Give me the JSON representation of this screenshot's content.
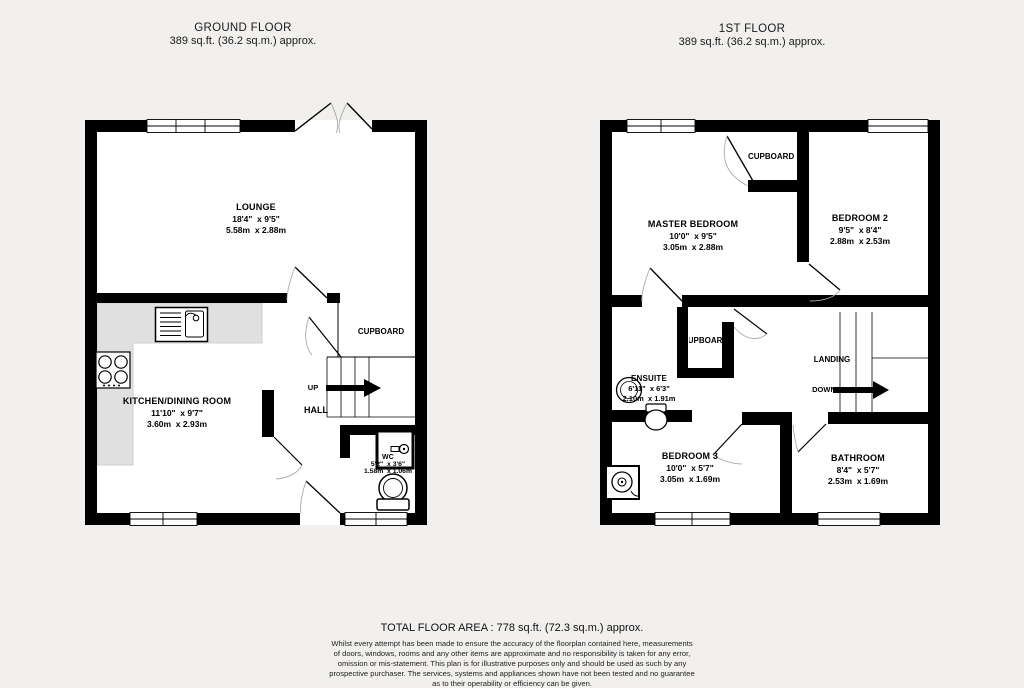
{
  "ground_floor": {
    "title": "GROUND FLOOR",
    "subtitle": "389 sq.ft. (36.2 sq.m.) approx.",
    "rooms": {
      "lounge": {
        "name": "LOUNGE",
        "imperial": "18'4\"  x 9'5\"",
        "metric": "5.58m  x 2.88m"
      },
      "kitchen": {
        "name": "KITCHEN/DINING ROOM",
        "imperial": "11'10\"  x 9'7\"",
        "metric": "3.60m  x 2.93m"
      },
      "wc": {
        "name": "WC",
        "imperial": "5'2\"  x 3'6\"",
        "metric": "1.58m  x 1.06m"
      },
      "cupboard": {
        "name": "CUPBOARD"
      },
      "hall": {
        "name": "HALL"
      }
    },
    "stairs_label": "UP"
  },
  "first_floor": {
    "title": "1ST FLOOR",
    "subtitle": "389 sq.ft. (36.2 sq.m.) approx.",
    "rooms": {
      "master_bedroom": {
        "name": "MASTER BEDROOM",
        "imperial": "10'0\"  x 9'5\"",
        "metric": "3.05m  x 2.88m"
      },
      "bedroom2": {
        "name": "BEDROOM 2",
        "imperial": "9'5\"  x 8'4\"",
        "metric": "2.88m  x 2.53m"
      },
      "ensuite": {
        "name": "ENSUITE",
        "imperial": "6'11\"  x 6'3\"",
        "metric": "2.10m  x 1.91m"
      },
      "bedroom3": {
        "name": "BEDROOM 3",
        "imperial": "10'0\"  x 5'7\"",
        "metric": "3.05m  x 1.69m"
      },
      "bathroom": {
        "name": "BATHROOM",
        "imperial": "8'4\"  x 5'7\"",
        "metric": "2.53m  x 1.69m"
      },
      "cupboard_top": {
        "name": "CUPBOARD"
      },
      "cupboard_mid": {
        "name": "CUPBOARD"
      },
      "landing": {
        "name": "LANDING"
      }
    },
    "stairs_label": "DOWN"
  },
  "footer": {
    "total": "TOTAL FLOOR AREA : 778 sq.ft. (72.3 sq.m.) approx.",
    "disclaimer_lines": [
      "Whilst every attempt has been made to ensure the accuracy of the floorplan contained here, measurements",
      "of doors, windows, rooms and any other items are approximate and no responsibility is taken for any error,",
      "omission or mis-statement. This plan is for illustrative purposes only and should be used as such by any",
      "prospective purchaser. The services, systems and appliances shown have not been tested and no guarantee",
      "as to their operability or efficiency can be given."
    ],
    "credit": "Made with Metropix ©2026"
  },
  "colors": {
    "background": "#f1f0ee",
    "wall": "#000000",
    "floor": "#ffffff",
    "counter": "#e0e0e0",
    "door_swing": "#aaaaaa"
  }
}
